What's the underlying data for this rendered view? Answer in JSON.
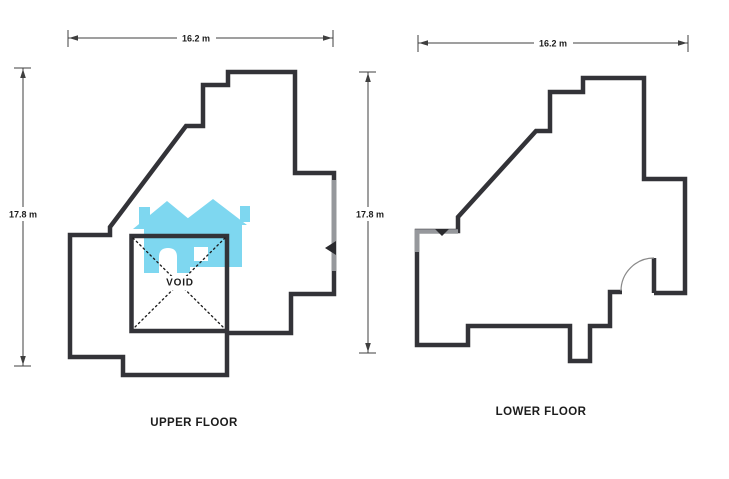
{
  "document": {
    "type": "floor-plan-scan"
  },
  "colors": {
    "wall": "#333338",
    "wall_faded": "#96989c",
    "dimension": "#3f3f3f",
    "text": "#1c1c1c",
    "watermark_blue": "#7ed7f0",
    "background": "#ffffff"
  },
  "upper_floor": {
    "name_label": "UPPER FLOOR",
    "width_label": "16.2 m",
    "height_label": "17.8 m",
    "void_label": "VOID"
  },
  "lower_floor": {
    "name_label": "LOWER FLOOR",
    "width_label": "16.2 m",
    "height_label": "17.8 m"
  },
  "watermark": {
    "icon": "houses-logo-icon"
  }
}
